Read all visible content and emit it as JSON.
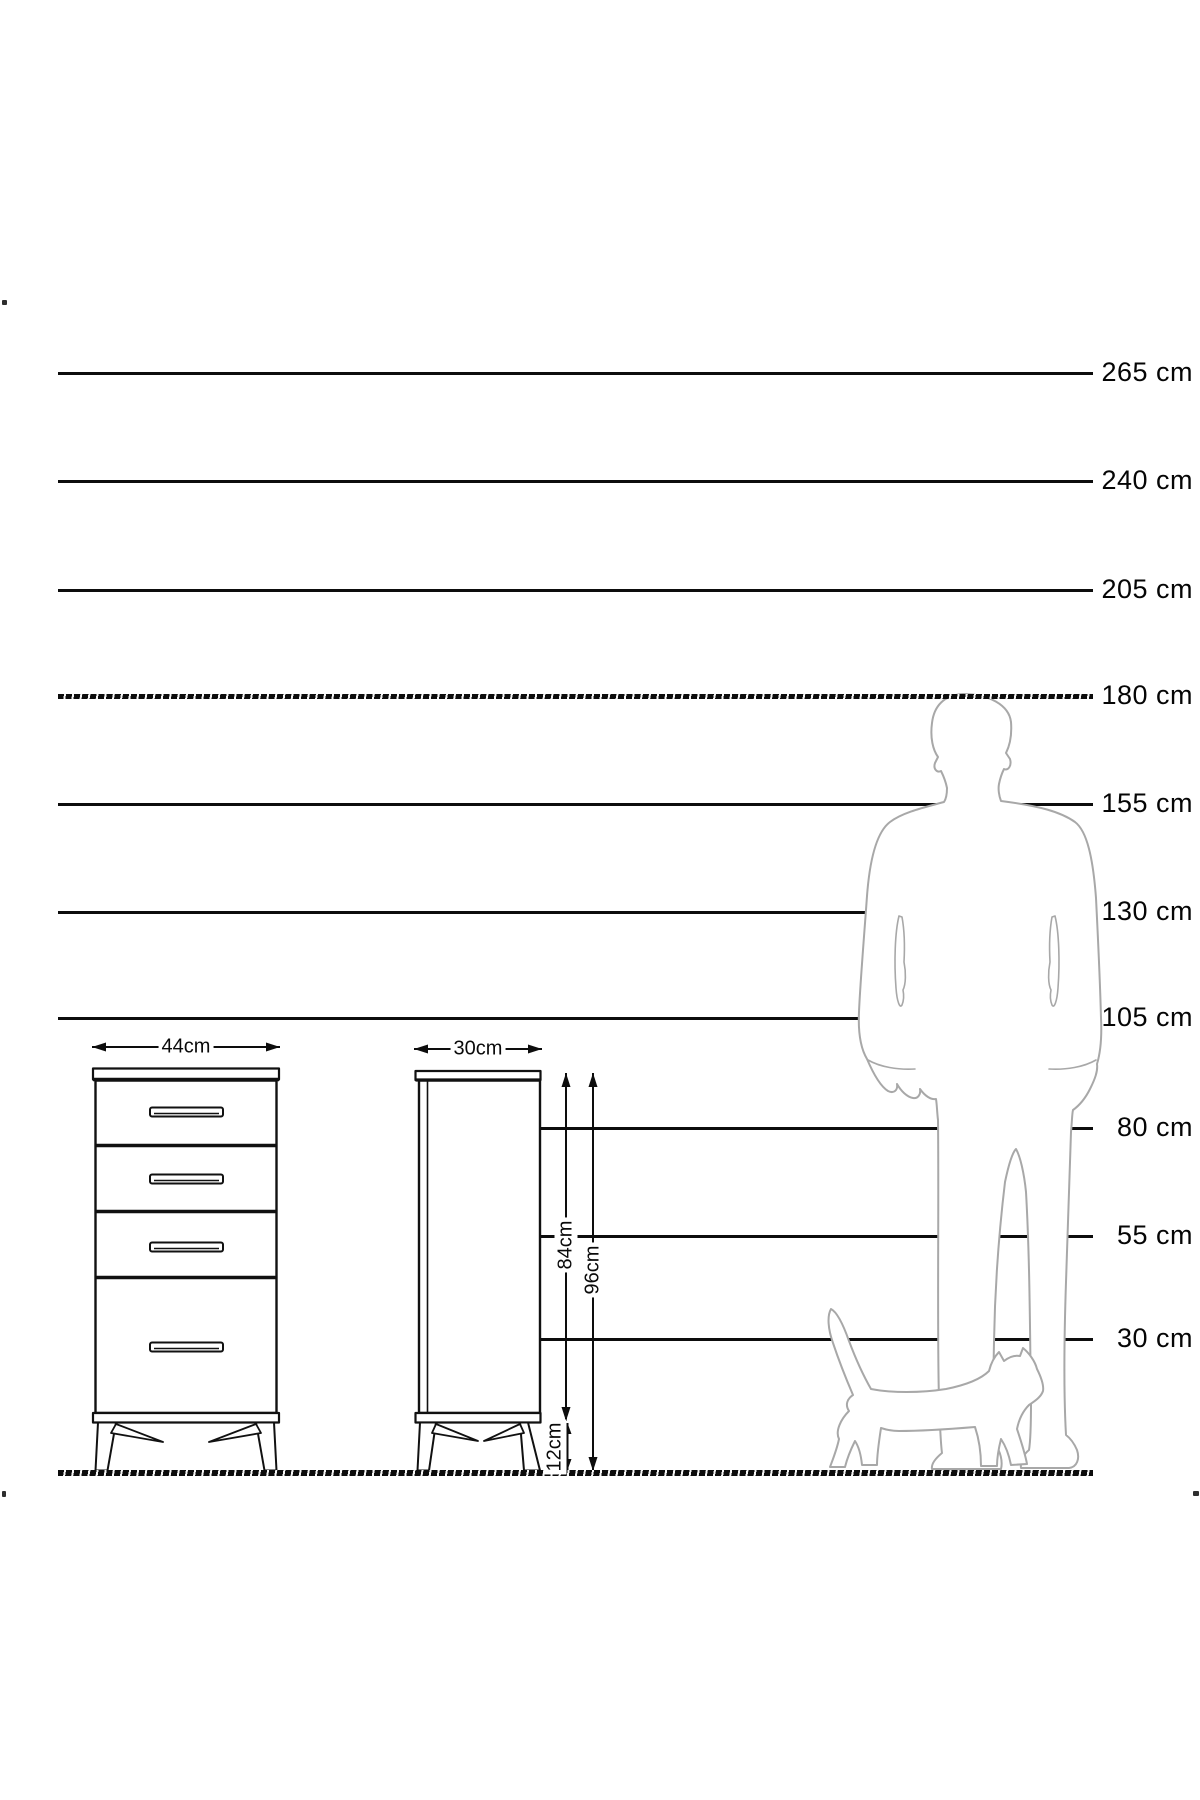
{
  "scale": {
    "labels": [
      "265 cm",
      "240 cm",
      "205 cm",
      "180 cm",
      "155 cm",
      "130 cm",
      "105 cm",
      "80 cm",
      "55 cm",
      "30 cm"
    ]
  },
  "dimensions": {
    "front_width": "44cm",
    "side_depth": "30cm",
    "carcass_height": "84cm",
    "total_height": "96cm",
    "leg_height": "12cm"
  },
  "figures": {
    "man": "man-silhouette",
    "cat": "cat-silhouette"
  },
  "colors": {
    "line": "#0d0d0d",
    "furniture_stroke": "#111111",
    "figure_stroke": "#a8a8a8",
    "background": "#ffffff"
  }
}
